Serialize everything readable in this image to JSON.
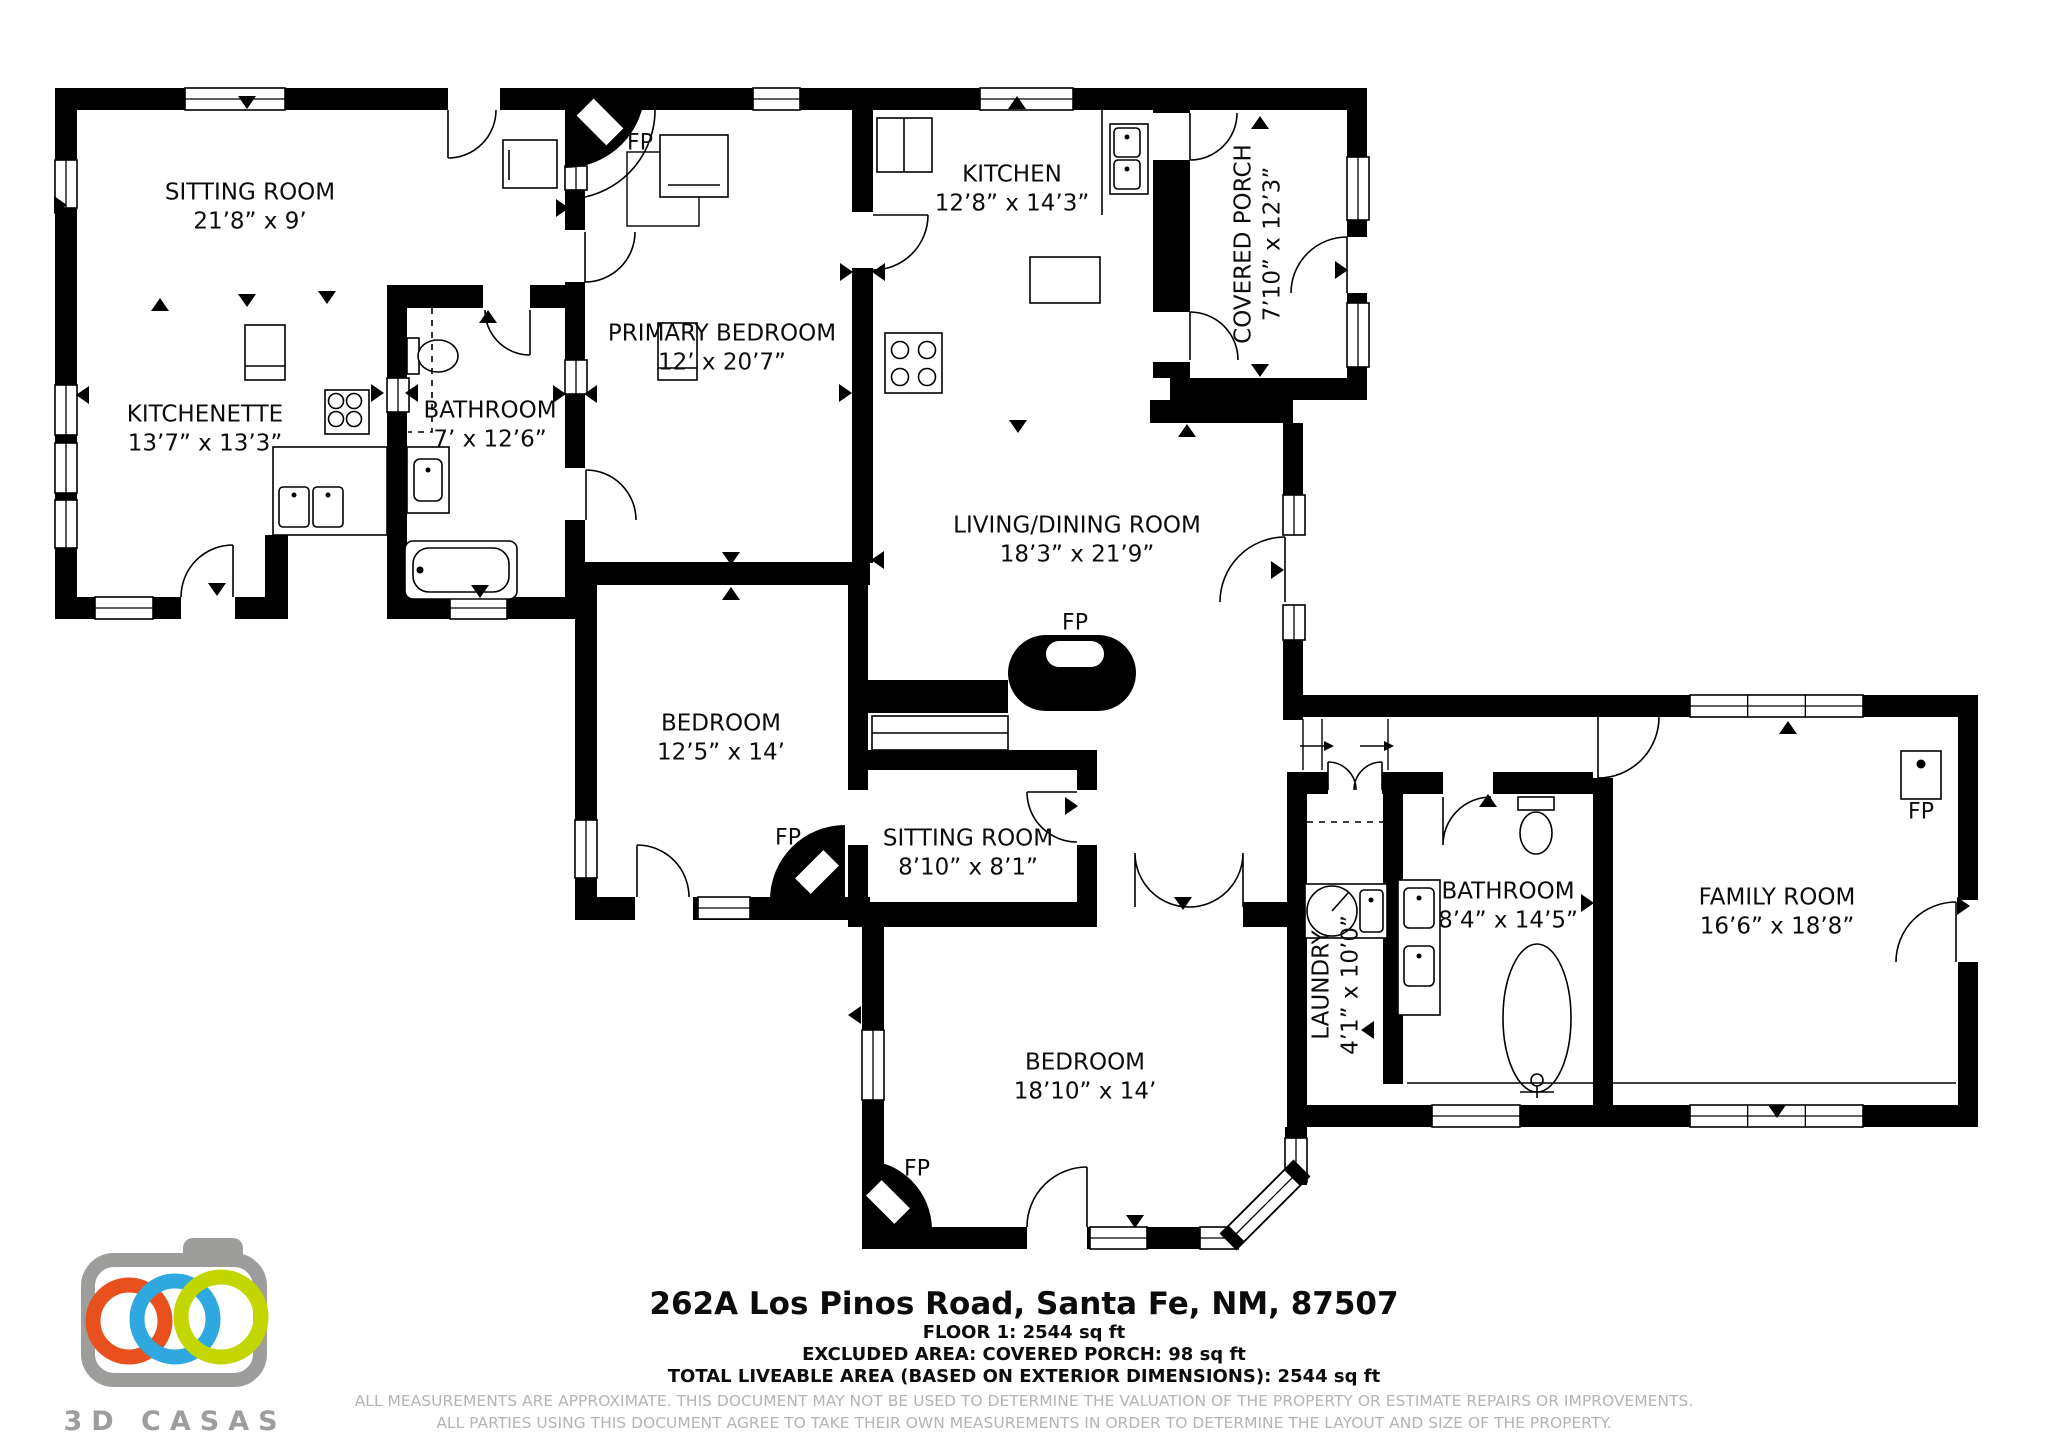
{
  "document": {
    "address": "262A Los Pinos Road, Santa Fe, NM, 87507",
    "floor_line": "FLOOR 1: 2544 sq ft",
    "excluded_line": "EXCLUDED AREA: COVERED PORCH: 98 sq ft",
    "total_line": "TOTAL LIVEABLE AREA (BASED ON EXTERIOR DIMENSIONS): 2544 sq ft",
    "disclaimer_line1": "ALL MEASUREMENTS ARE APPROXIMATE. THIS DOCUMENT MAY NOT BE USED TO DETERMINE THE VALUATION OF THE PROPERTY OR ESTIMATE REPAIRS OR IMPROVEMENTS.",
    "disclaimer_line2": "ALL PARTIES USING THIS DOCUMENT AGREE TO TAKE THEIR OWN MEASUREMENTS IN ORDER TO DETERMINE THE LAYOUT AND SIZE OF THE PROPERTY."
  },
  "branding": {
    "brand": "3D CASAS",
    "camera_color": "#9d9d9c",
    "ring_colors": [
      "#E8501E",
      "#2FA8E0",
      "#C3D600"
    ]
  },
  "floorplan": {
    "fireplace_label": "FP",
    "wall_color": "#000000",
    "rooms": [
      {
        "id": "sitting-room-1",
        "name": "SITTING ROOM",
        "dims": "21’8” x 9’",
        "x": 250,
        "y": 208,
        "rot": 0
      },
      {
        "id": "kitchenette",
        "name": "KITCHENETTE",
        "dims": "13’7” x 13’3”",
        "x": 205,
        "y": 430,
        "rot": 0
      },
      {
        "id": "bathroom-1",
        "name": "BATHROOM",
        "dims": "7’ x 12’6”",
        "x": 490,
        "y": 426,
        "rot": 0
      },
      {
        "id": "primary-bedroom",
        "name": "PRIMARY BEDROOM",
        "dims": "12’ x 20’7”",
        "x": 722,
        "y": 349,
        "rot": 0
      },
      {
        "id": "kitchen",
        "name": "KITCHEN",
        "dims": "12’8” x 14’3”",
        "x": 1012,
        "y": 190,
        "rot": 0
      },
      {
        "id": "covered-porch",
        "name": "COVERED PORCH",
        "dims": "7’10” x 12’3”",
        "x": 1259,
        "y": 244,
        "rot": -90
      },
      {
        "id": "living-dining-room",
        "name": "LIVING/DINING ROOM",
        "dims": "18’3” x 21’9”",
        "x": 1077,
        "y": 541,
        "rot": 0
      },
      {
        "id": "bedroom-1",
        "name": "BEDROOM",
        "dims": "12’5” x 14’",
        "x": 721,
        "y": 739,
        "rot": 0
      },
      {
        "id": "sitting-room-2",
        "name": "SITTING ROOM",
        "dims": "8’10” x 8’1”",
        "x": 968,
        "y": 854,
        "rot": 0
      },
      {
        "id": "bedroom-2",
        "name": "BEDROOM",
        "dims": "18’10” x 14’",
        "x": 1085,
        "y": 1078,
        "rot": 0
      },
      {
        "id": "laundry",
        "name": "LAUNDRY",
        "dims": "4’1” x 10’0”",
        "x": 1337,
        "y": 985,
        "rot": -90
      },
      {
        "id": "bathroom-2",
        "name": "BATHROOM",
        "dims": "8’4” x 14’5”",
        "x": 1508,
        "y": 907,
        "rot": 0
      },
      {
        "id": "family-room",
        "name": "FAMILY ROOM",
        "dims": "16’6” x 18’8”",
        "x": 1777,
        "y": 913,
        "rot": 0
      }
    ],
    "fp_markers": [
      {
        "x": 640,
        "y": 143
      },
      {
        "x": 1075,
        "y": 623
      },
      {
        "x": 788,
        "y": 838
      },
      {
        "x": 917,
        "y": 1169
      },
      {
        "x": 1921,
        "y": 812
      }
    ]
  }
}
